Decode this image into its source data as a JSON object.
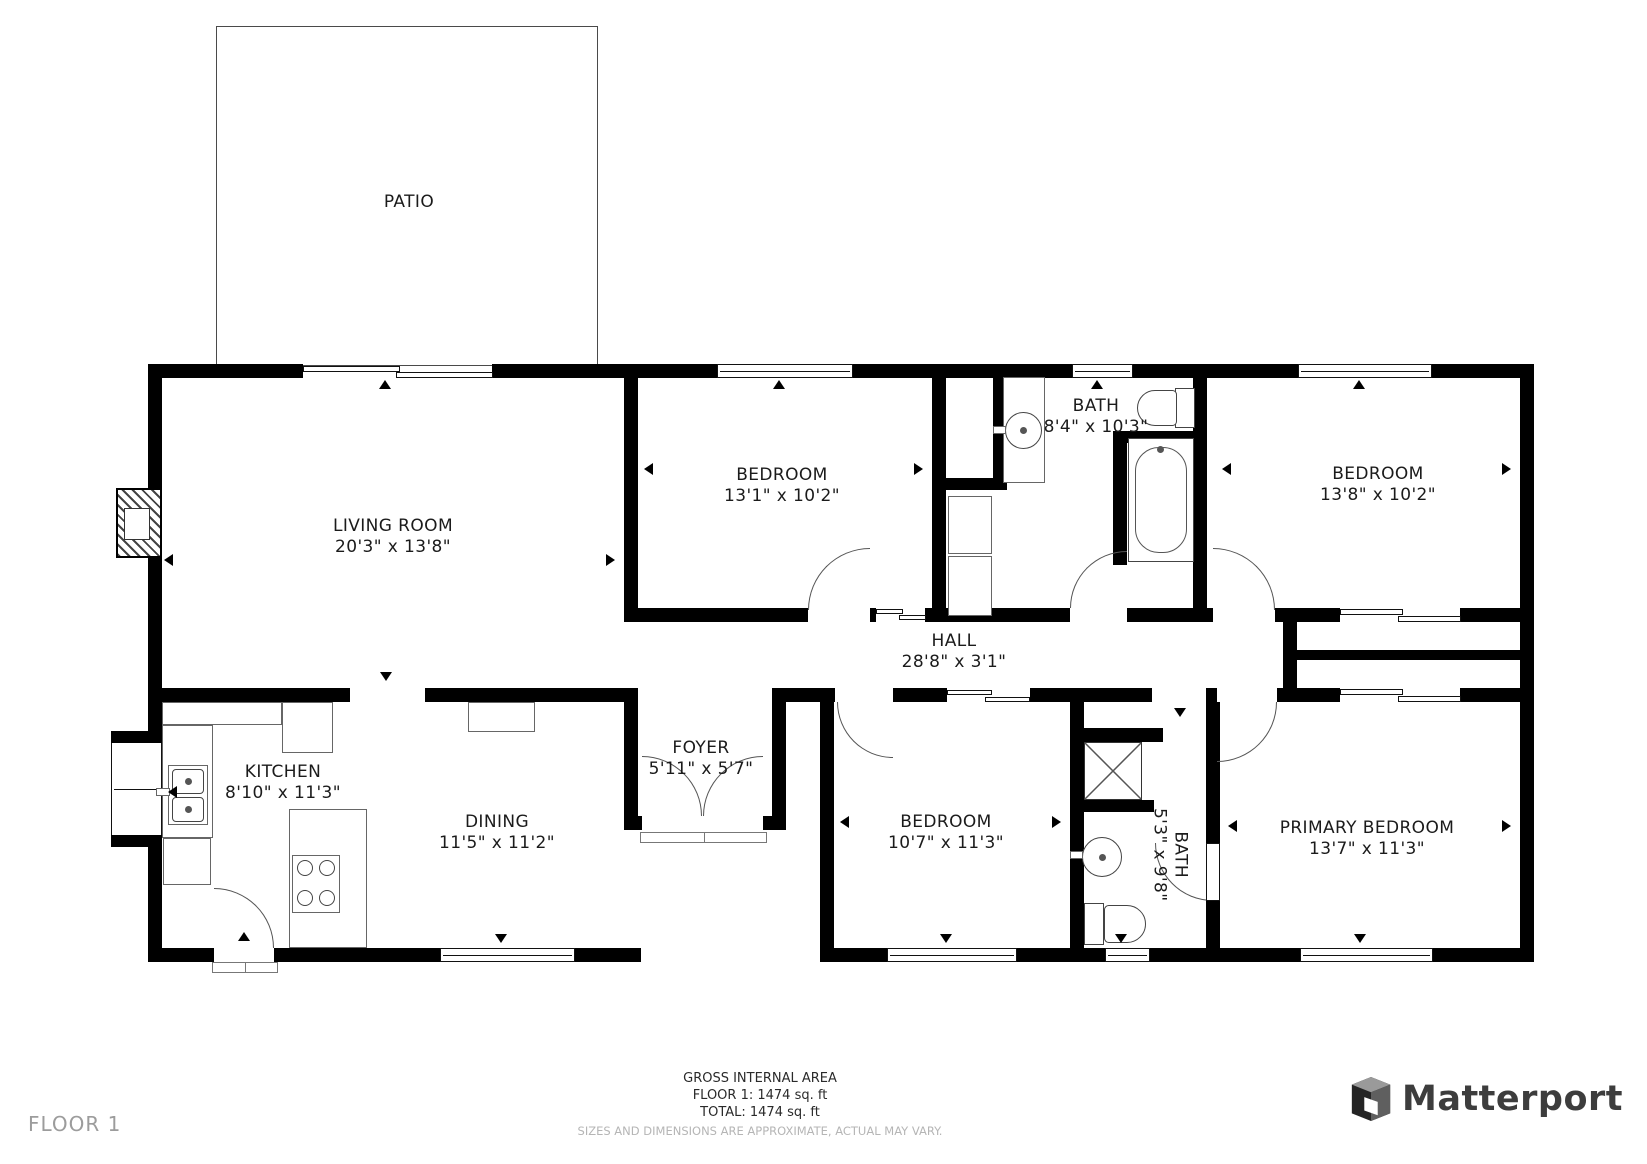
{
  "plan_title": "Residential floor plan",
  "colors": {
    "wall": "#000000",
    "label": "#1b1b1b",
    "muted": "#b5b5b5",
    "floor_tag": "#9c9c9c",
    "brand": "#3d3d3d"
  },
  "rooms": {
    "patio": {
      "name": "PATIO",
      "dims": ""
    },
    "living_room": {
      "name": "LIVING ROOM",
      "dims": "20'3\" x 13'8\""
    },
    "bedroom_top": {
      "name": "BEDROOM",
      "dims": "13'1\" x 10'2\""
    },
    "bath_top": {
      "name": "BATH",
      "dims": "8'4\" x 10'3\""
    },
    "bedroom_right": {
      "name": "BEDROOM",
      "dims": "13'8\" x 10'2\""
    },
    "hall": {
      "name": "HALL",
      "dims": "28'8\" x 3'1\""
    },
    "kitchen": {
      "name": "KITCHEN",
      "dims": "8'10\" x 11'3\""
    },
    "dining": {
      "name": "DINING",
      "dims": "11'5\" x 11'2\""
    },
    "foyer": {
      "name": "FOYER",
      "dims": "5'11\" x 5'7\""
    },
    "bedroom_bottom": {
      "name": "BEDROOM",
      "dims": "10'7\" x 11'3\""
    },
    "bath_bottom": {
      "name": "BATH",
      "dims": "5'3\" x 9'8\""
    },
    "primary_bedroom": {
      "name": "PRIMARY BEDROOM",
      "dims": "13'7\" x 11'3\""
    }
  },
  "footer": {
    "area_title": "GROSS INTERNAL AREA",
    "floor_line": "FLOOR 1: 1474 sq. ft",
    "total_line": "TOTAL: 1474 sq. ft",
    "disclaimer": "SIZES AND DIMENSIONS ARE APPROXIMATE, ACTUAL MAY VARY."
  },
  "floor_label": "FLOOR 1",
  "brand": {
    "name": "Matterport"
  }
}
